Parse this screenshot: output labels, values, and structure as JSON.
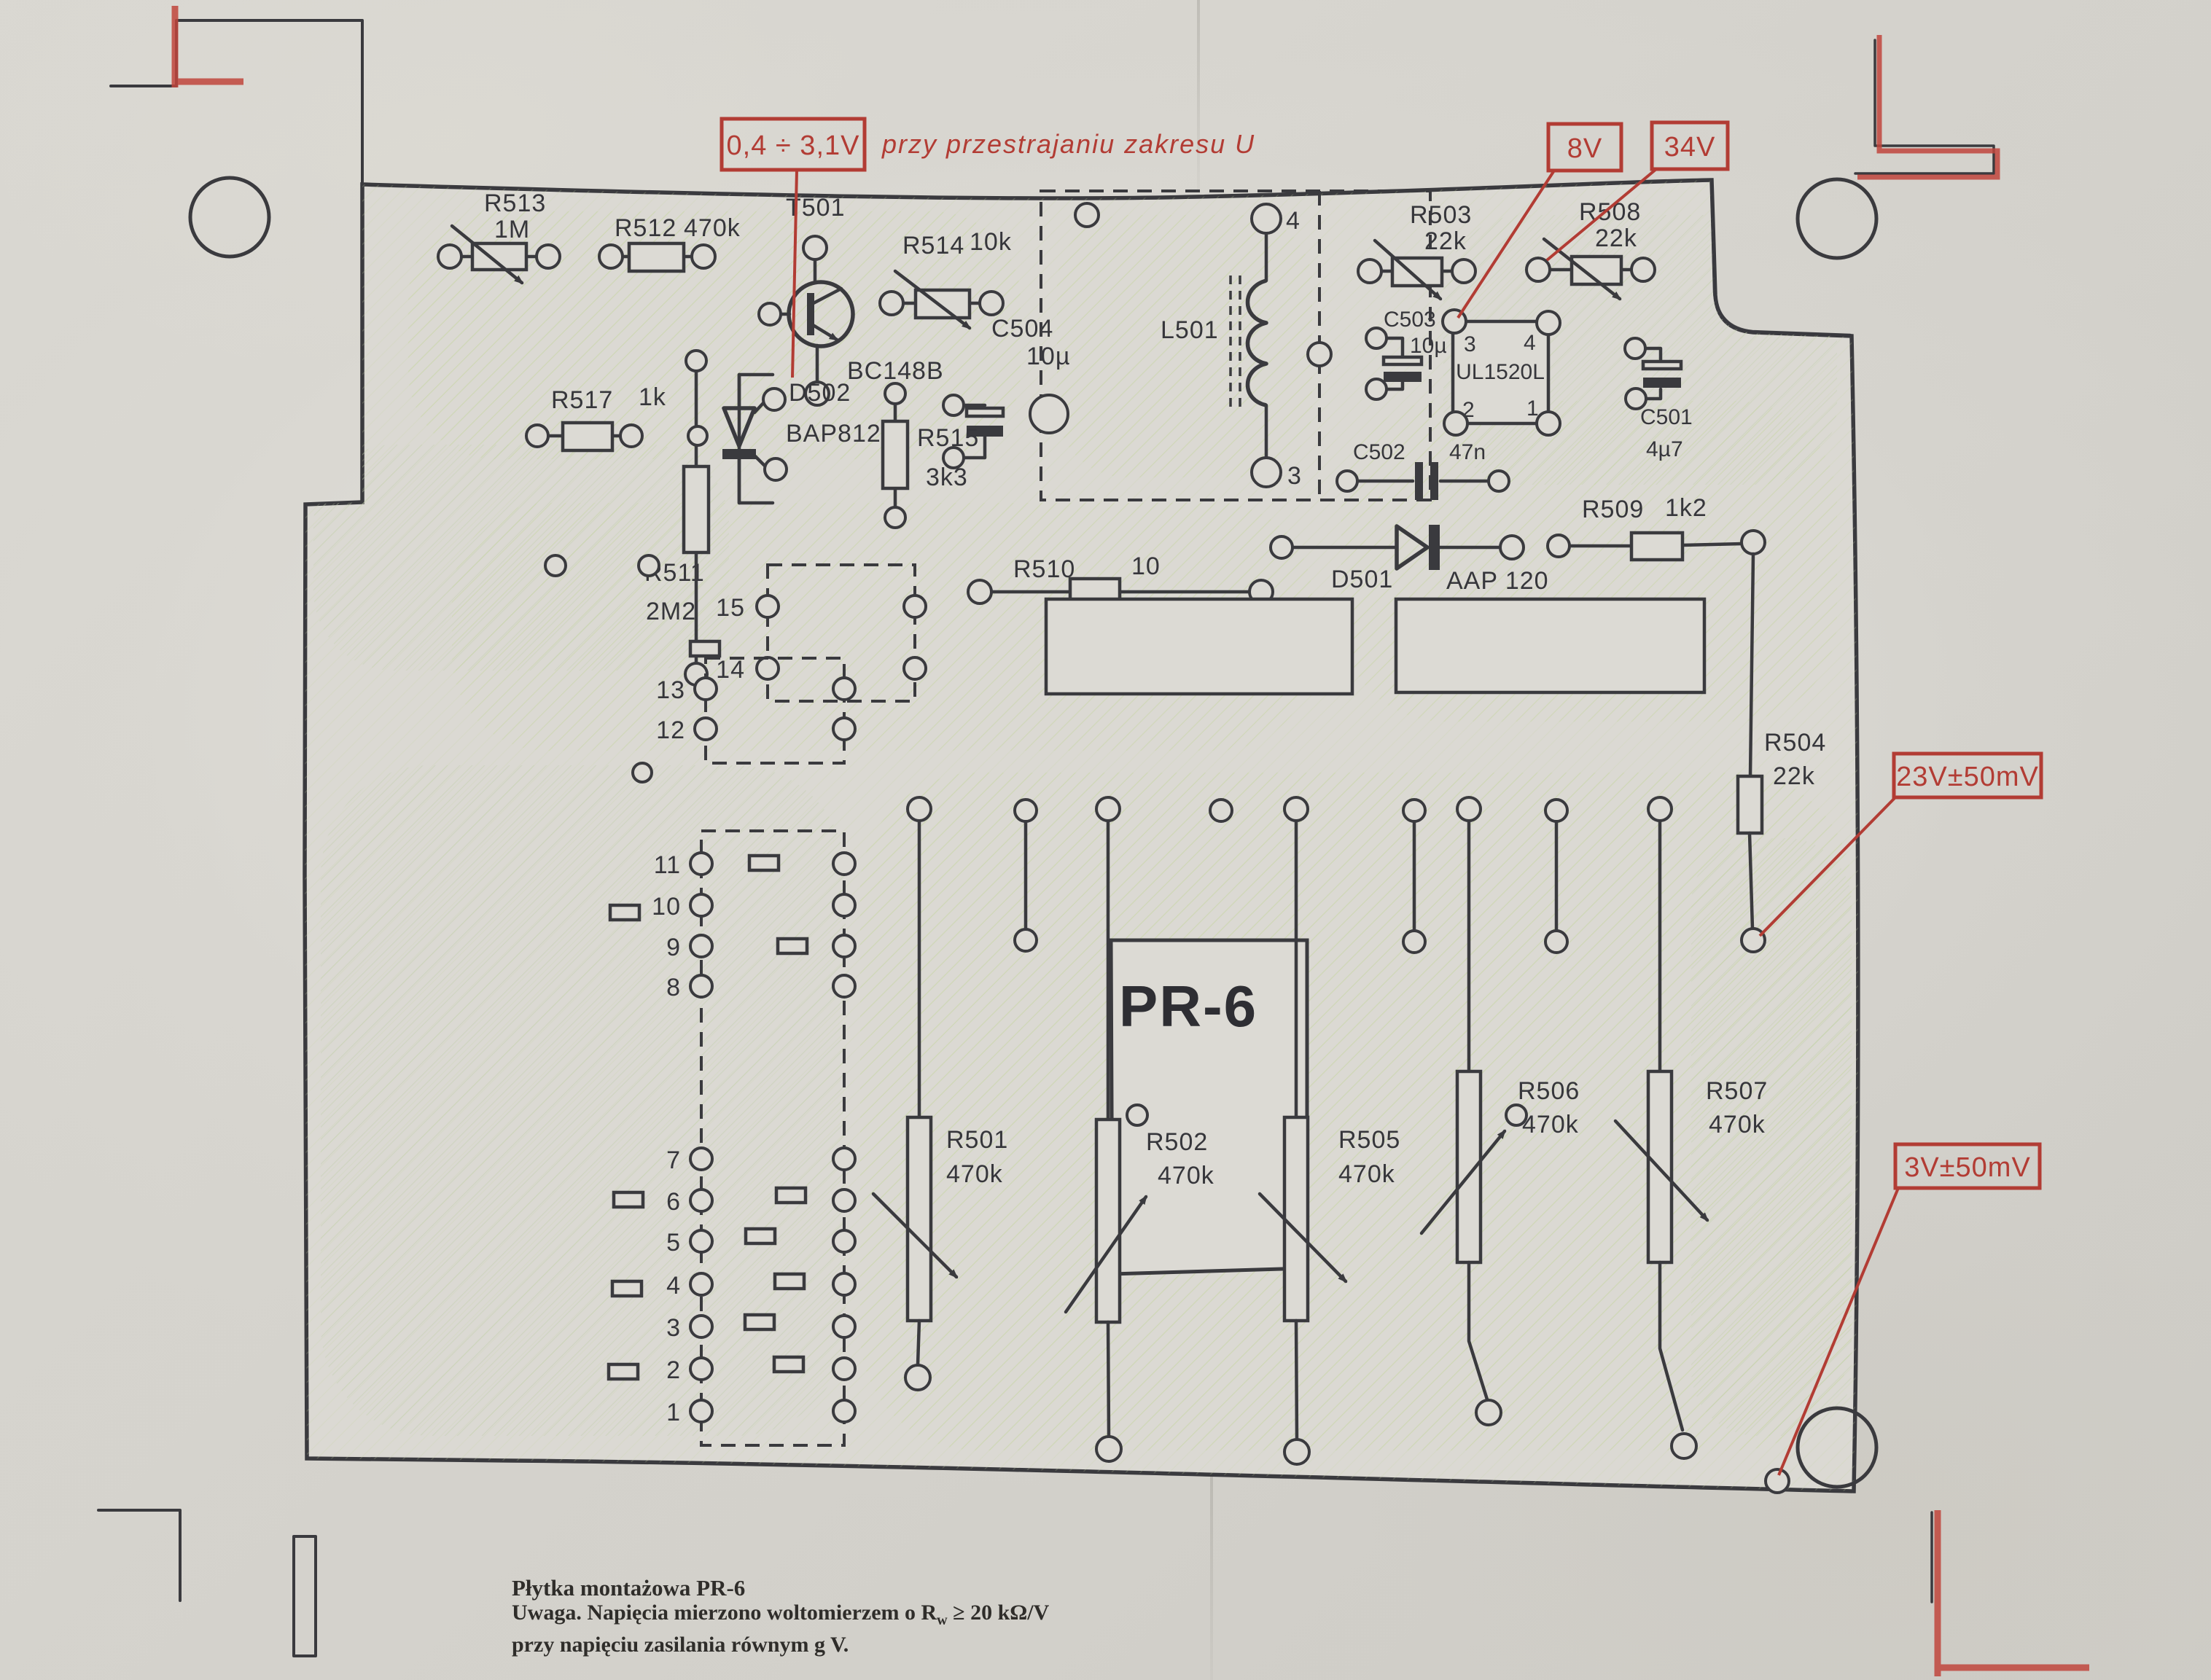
{
  "annotations": {
    "tune_range": "0,4 ÷ 3,1V",
    "tune_note": "przy przestrajaniu zakresu U",
    "v8": "8V",
    "v34": "34V",
    "v23": "23V±50mV",
    "v3": "3V±50mV"
  },
  "board_name": "PR-6",
  "transistor": {
    "ref": "T501",
    "type": "BC148B"
  },
  "inductor": {
    "ref": "L501",
    "pin_top": "4",
    "pin_bottom": "3"
  },
  "ic": {
    "ref": "UL1520L",
    "pin3": "3",
    "pin4": "4",
    "pin2": "2",
    "pin1": "1"
  },
  "components": {
    "r513": {
      "ref": "R513",
      "value": "1M"
    },
    "r512": {
      "ref": "R512",
      "value": "470k"
    },
    "r514": {
      "ref": "R514",
      "value": "10k"
    },
    "r517": {
      "ref": "R517",
      "value": "1k"
    },
    "r515": {
      "ref": "R515",
      "value": "3k3"
    },
    "r511": {
      "ref": "R511",
      "value": "2M2"
    },
    "r510": {
      "ref": "R510",
      "value": "10"
    },
    "r509": {
      "ref": "R509",
      "value": "1k2"
    },
    "r504": {
      "ref": "R504",
      "value": "22k"
    },
    "r503": {
      "ref": "R503",
      "value": "22k"
    },
    "r508": {
      "ref": "R508",
      "value": "22k"
    },
    "r501": {
      "ref": "R501",
      "value": "470k"
    },
    "r502": {
      "ref": "R502",
      "value": "470k"
    },
    "r505": {
      "ref": "R505",
      "value": "470k"
    },
    "r506": {
      "ref": "R506",
      "value": "470k"
    },
    "r507": {
      "ref": "R507",
      "value": "470k"
    },
    "c504": {
      "ref": "C504",
      "value": "10µ"
    },
    "c503": {
      "ref": "C503",
      "value": "10µ"
    },
    "c502": {
      "ref": "C502",
      "value": "47n"
    },
    "c501": {
      "ref": "C501",
      "value": "4µ7"
    },
    "d502": {
      "ref": "D502",
      "value": "BAP812"
    },
    "d501": {
      "ref": "D501",
      "value": "AAP 120"
    }
  },
  "pads": {
    "numbers": [
      "15",
      "14",
      "13",
      "12",
      "11",
      "10",
      "9",
      "8",
      "7",
      "6",
      "5",
      "4",
      "3",
      "2",
      "1"
    ]
  },
  "caption": {
    "title": "Płytka montażowa PR-6",
    "note_a": "Uwaga. Napięcia mierzono woltomierzem o R",
    "note_sub": "w",
    "note_b": " ≥ 20 kΩ/V",
    "note_line2": "przy napięciu zasilania równym g V."
  },
  "colors": {
    "ink": "#3a3a3e",
    "red": "#b23c34",
    "paper": "#dcdad4",
    "hatch": "#c9d6a8"
  }
}
